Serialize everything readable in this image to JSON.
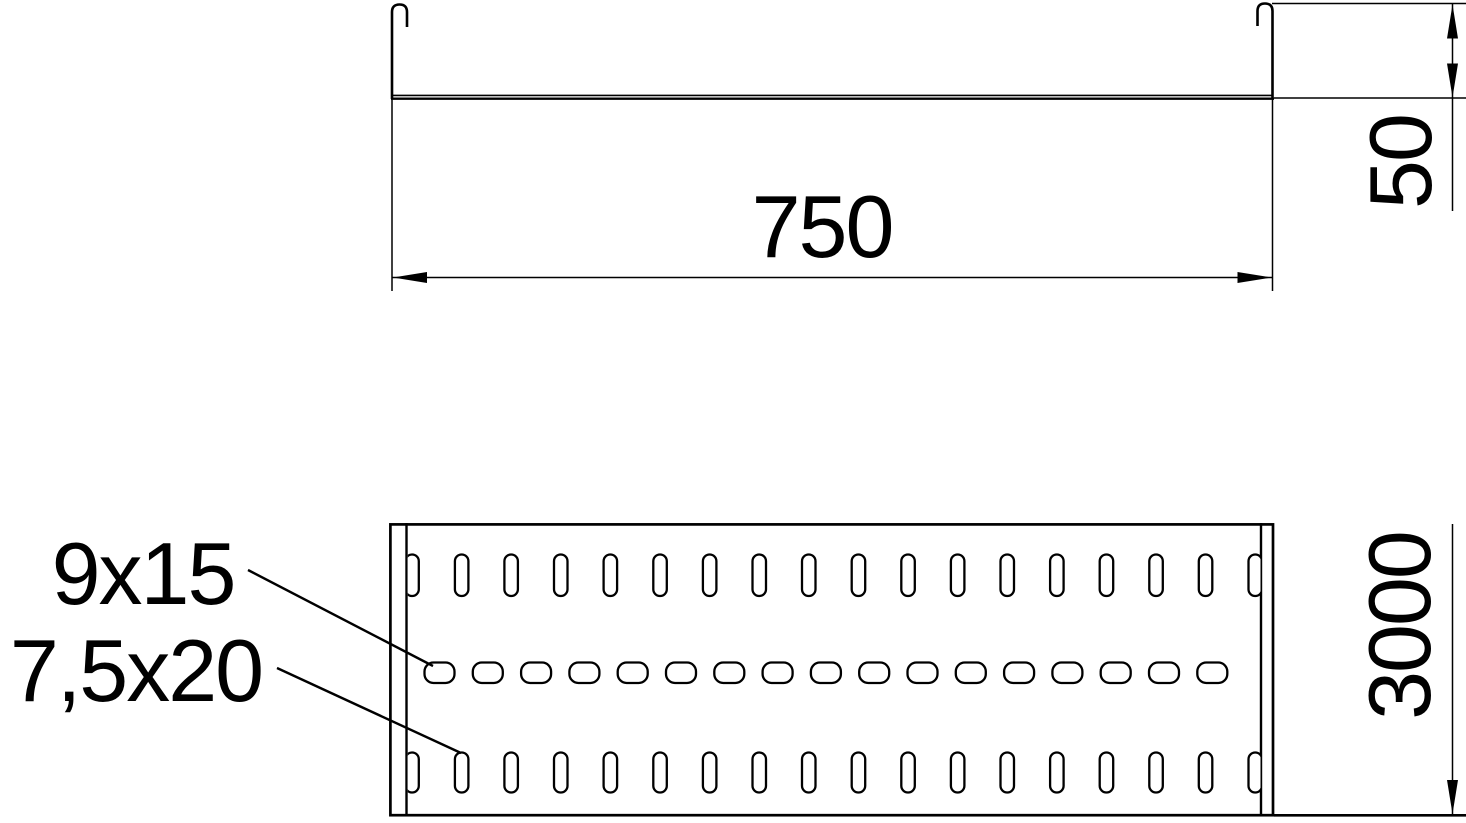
{
  "drawing": {
    "type": "technical-drawing",
    "description": "Cable tray: end profile view (top) and perforated bottom view (below)",
    "background_color": "#ffffff",
    "line_color": "#000000",
    "dimensions": {
      "width": {
        "label": "750"
      },
      "height": {
        "label": "50"
      },
      "length": {
        "label": "3000"
      }
    },
    "slot_callouts": {
      "middle_slot": {
        "label": "9x15"
      },
      "edge_slot": {
        "label": "7,5x20"
      }
    },
    "perforation_rows": [
      {
        "name": "top-slot-row",
        "slot_size": "7,5x20",
        "count": 18,
        "cx_start": 412,
        "pitch": 49.6,
        "y": 554.5,
        "w": 13.5,
        "h": 41.5,
        "rx": 6.7
      },
      {
        "name": "middle-slot-row",
        "slot_size": "9x15",
        "count": 17,
        "cx_start": 439.5,
        "pitch": 48.3,
        "y": 662.5,
        "w": 30,
        "h": 20.5,
        "rx": 9
      },
      {
        "name": "bottom-slot-row",
        "slot_size": "7,5x20",
        "count": 18,
        "cx_start": 412,
        "pitch": 49.6,
        "y": 752.5,
        "w": 13.5,
        "h": 40,
        "rx": 6.7
      }
    ]
  }
}
